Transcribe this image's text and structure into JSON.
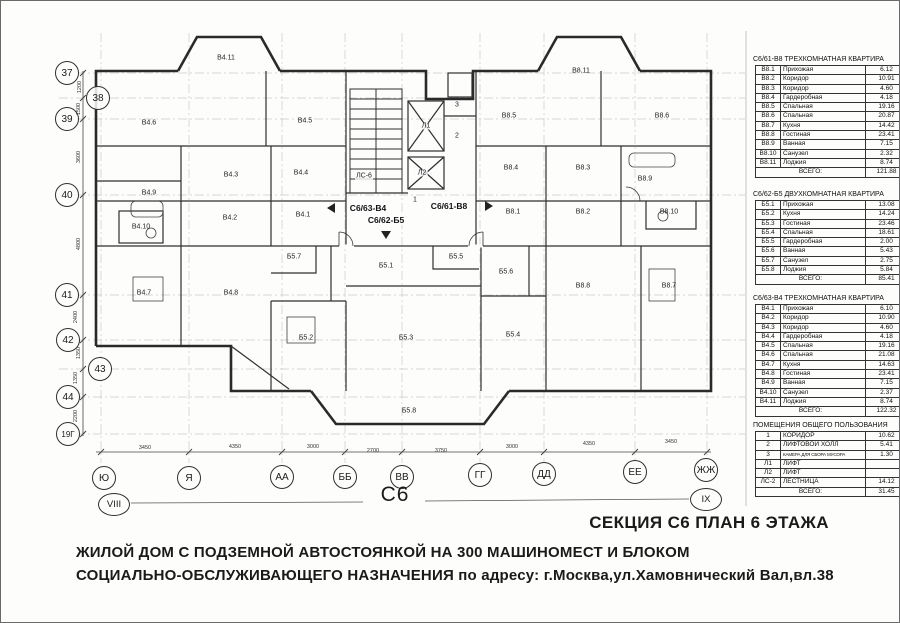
{
  "titles": {
    "section_plan": "СЕКЦИЯ С6 ПЛАН 6 ЭТАЖА",
    "project_line1": "ЖИЛОЙ ДОМ С ПОДЗЕМНОЙ АВТОСТОЯНКОЙ НА 300 МАШИНОМЕСТ И БЛОКОМ",
    "project_line2": "СОЦИАЛЬНО-ОБСЛУЖИВАЮЩЕГО  НАЗНАЧЕНИЯ по адресу: г.Москва,ул.Хамовнический Вал,вл.38",
    "section_label": "С6"
  },
  "axes": {
    "left_circles": [
      {
        "label": "37",
        "x": 66,
        "y": 72
      },
      {
        "label": "38",
        "x": 97,
        "y": 97
      },
      {
        "label": "39",
        "x": 66,
        "y": 118
      },
      {
        "label": "40",
        "x": 66,
        "y": 194
      },
      {
        "label": "41",
        "x": 66,
        "y": 294
      },
      {
        "label": "42",
        "x": 67,
        "y": 339
      },
      {
        "label": "43",
        "x": 99,
        "y": 368
      },
      {
        "label": "44",
        "x": 67,
        "y": 396
      },
      {
        "label": "19Г",
        "x": 67,
        "y": 433
      }
    ],
    "left_dims": [
      {
        "text": "1200",
        "x": 79,
        "y": 86
      },
      {
        "text": "1500",
        "x": 78,
        "y": 108
      },
      {
        "text": "3600",
        "x": 78,
        "y": 156
      },
      {
        "text": "4800",
        "x": 78,
        "y": 243
      },
      {
        "text": "2400",
        "x": 75,
        "y": 316
      },
      {
        "text": "1350",
        "x": 78,
        "y": 352
      },
      {
        "text": "1350",
        "x": 75,
        "y": 377
      },
      {
        "text": "2200",
        "x": 75,
        "y": 415
      }
    ],
    "bottom_circles": [
      {
        "label": "Ю",
        "x": 103,
        "y": 477
      },
      {
        "label": "Я",
        "x": 188,
        "y": 477
      },
      {
        "label": "АА",
        "x": 281,
        "y": 476
      },
      {
        "label": "ББ",
        "x": 344,
        "y": 476
      },
      {
        "label": "ВВ",
        "x": 401,
        "y": 476
      },
      {
        "label": "ГГ",
        "x": 479,
        "y": 474
      },
      {
        "label": "ДД",
        "x": 543,
        "y": 473
      },
      {
        "label": "ЕЕ",
        "x": 634,
        "y": 471
      },
      {
        "label": "ЖЖ",
        "x": 705,
        "y": 469
      }
    ],
    "bottom_dims": [
      {
        "text": "3450",
        "x": 144,
        "y": 447
      },
      {
        "text": "4350",
        "x": 234,
        "y": 446
      },
      {
        "text": "3000",
        "x": 312,
        "y": 446
      },
      {
        "text": "2700",
        "x": 372,
        "y": 450
      },
      {
        "text": "3750",
        "x": 440,
        "y": 450
      },
      {
        "text": "3000",
        "x": 511,
        "y": 446
      },
      {
        "text": "4350",
        "x": 588,
        "y": 443
      },
      {
        "text": "3450",
        "x": 670,
        "y": 441
      }
    ],
    "roman_left": {
      "label": "VIII",
      "x": 113,
      "y": 503
    },
    "roman_right": {
      "label": "IX",
      "x": 705,
      "y": 498
    }
  },
  "plan": {
    "room_labels": [
      {
        "id": "В4.11",
        "x": 225,
        "y": 57
      },
      {
        "id": "В4.6",
        "x": 148,
        "y": 122
      },
      {
        "id": "В4.5",
        "x": 304,
        "y": 120
      },
      {
        "id": "В4.3",
        "x": 230,
        "y": 174
      },
      {
        "id": "В4.4",
        "x": 300,
        "y": 172
      },
      {
        "id": "В4.9",
        "x": 148,
        "y": 192
      },
      {
        "id": "В4.10",
        "x": 140,
        "y": 226
      },
      {
        "id": "В4.2",
        "x": 229,
        "y": 217
      },
      {
        "id": "В4.1",
        "x": 302,
        "y": 214
      },
      {
        "id": "В4.7",
        "x": 143,
        "y": 292
      },
      {
        "id": "В4.8",
        "x": 230,
        "y": 292
      },
      {
        "id": "Б5.7",
        "x": 293,
        "y": 256
      },
      {
        "id": "Б5.1",
        "x": 385,
        "y": 265
      },
      {
        "id": "Б5.5",
        "x": 455,
        "y": 256
      },
      {
        "id": "Б5.6",
        "x": 505,
        "y": 271
      },
      {
        "id": "Б5.2",
        "x": 305,
        "y": 337
      },
      {
        "id": "Б5.3",
        "x": 405,
        "y": 337
      },
      {
        "id": "Б5.4",
        "x": 512,
        "y": 334
      },
      {
        "id": "Б5.8",
        "x": 408,
        "y": 410
      },
      {
        "id": "В8.11",
        "x": 580,
        "y": 70
      },
      {
        "id": "В8.5",
        "x": 508,
        "y": 115
      },
      {
        "id": "В8.6",
        "x": 661,
        "y": 115
      },
      {
        "id": "В8.4",
        "x": 510,
        "y": 167
      },
      {
        "id": "В8.3",
        "x": 582,
        "y": 167
      },
      {
        "id": "В8.9",
        "x": 644,
        "y": 178
      },
      {
        "id": "В8.1",
        "x": 512,
        "y": 211
      },
      {
        "id": "В8.2",
        "x": 582,
        "y": 211
      },
      {
        "id": "В8.10",
        "x": 668,
        "y": 211
      },
      {
        "id": "В8.8",
        "x": 582,
        "y": 285
      },
      {
        "id": "В8.7",
        "x": 668,
        "y": 285
      }
    ],
    "core_labels": [
      {
        "text": "ЛС-6",
        "x": 363,
        "y": 175
      },
      {
        "text": "Л1",
        "x": 425,
        "y": 125
      },
      {
        "text": "Л2",
        "x": 421,
        "y": 172
      },
      {
        "text": "1",
        "x": 414,
        "y": 199
      },
      {
        "text": "2",
        "x": 456,
        "y": 135
      },
      {
        "text": "3",
        "x": 456,
        "y": 104
      }
    ],
    "apartment_refs": [
      {
        "text": "С6/63-В4",
        "x": 367,
        "y": 207
      },
      {
        "text": "С6/62-Б5",
        "x": 385,
        "y": 219
      },
      {
        "text": "С6/61-В8",
        "x": 448,
        "y": 205
      }
    ]
  },
  "tables": [
    {
      "top": 55,
      "title": "С6/61-В8 ТРЕХКОМНАТНАЯ КВАРТИРА",
      "total_label": "ВСЕГО:",
      "total": "121.88",
      "rows": [
        [
          "В8.1",
          "Прихожая",
          "6.12"
        ],
        [
          "В8.2",
          "Коридор",
          "10.91"
        ],
        [
          "В8.3",
          "Коридор",
          "4.60"
        ],
        [
          "В8.4",
          "Гардеробная",
          "4.18"
        ],
        [
          "В8.5",
          "Спальная",
          "19.16"
        ],
        [
          "В8.6",
          "Спальная",
          "20.87"
        ],
        [
          "В8.7",
          "Кухня",
          "14.42"
        ],
        [
          "В8.8",
          "Гостиная",
          "23.41"
        ],
        [
          "В8.9",
          "Ванная",
          "7.15"
        ],
        [
          "В8.10",
          "Санузел",
          "2.32"
        ],
        [
          "В8.11",
          "Лоджия",
          "8.74"
        ]
      ]
    },
    {
      "top": 190,
      "title": "С6/62-Б5 ДВУХКОМНАТНАЯ КВАРТИРА",
      "total_label": "ВСЕГО:",
      "total": "85.41",
      "rows": [
        [
          "Б5.1",
          "Прихожая",
          "13.08"
        ],
        [
          "Б5.2",
          "Кухня",
          "14.24"
        ],
        [
          "Б5.3",
          "Гостиная",
          "23.46"
        ],
        [
          "Б5.4",
          "Спальная",
          "18.61"
        ],
        [
          "Б5.5",
          "Гардеробная",
          "2.00"
        ],
        [
          "Б5.6",
          "Ванная",
          "5.43"
        ],
        [
          "Б5.7",
          "Санузел",
          "2.75"
        ],
        [
          "Б5.8",
          "Лоджия",
          "5.84"
        ]
      ]
    },
    {
      "top": 294,
      "title": "С6/63-В4 ТРЕХКОМНАТНАЯ КВАРТИРА",
      "total_label": "ВСЕГО:",
      "total": "122.32",
      "rows": [
        [
          "В4.1",
          "Прихожая",
          "6.10"
        ],
        [
          "В4.2",
          "Коридор",
          "10.90"
        ],
        [
          "В4.3",
          "Коридор",
          "4.60"
        ],
        [
          "В4.4",
          "Гардеробная",
          "4.18"
        ],
        [
          "В4.5",
          "Спальная",
          "19.16"
        ],
        [
          "В4.6",
          "Спальная",
          "21.08"
        ],
        [
          "В4.7",
          "Кухня",
          "14.63"
        ],
        [
          "В4.8",
          "Гостиная",
          "23.41"
        ],
        [
          "В4.9",
          "Ванная",
          "7.15"
        ],
        [
          "В4.10",
          "Санузел",
          "2.37"
        ],
        [
          "В4.11",
          "Лоджия",
          "8.74"
        ]
      ]
    },
    {
      "top": 421,
      "title": "ПОМЕЩЕНИЯ ОБЩЕГО ПОЛЬЗОВАНИЯ",
      "total_label": "ВСЕГО:",
      "total": "31.45",
      "rows": [
        [
          "1",
          "КОРИДОР",
          "10.62"
        ],
        [
          "2",
          "ЛИФТОВОЙ ХОЛЛ",
          "5.41"
        ],
        [
          "3",
          "КАМЕРА ДЛЯ СБОРА МУСОРА",
          "1.30"
        ],
        [
          "Л1",
          "ЛИФТ",
          ""
        ],
        [
          "Л2",
          "ЛИФТ",
          ""
        ],
        [
          "ЛС-2",
          "ЛЕСТНИЦА",
          "14.12"
        ]
      ]
    }
  ]
}
